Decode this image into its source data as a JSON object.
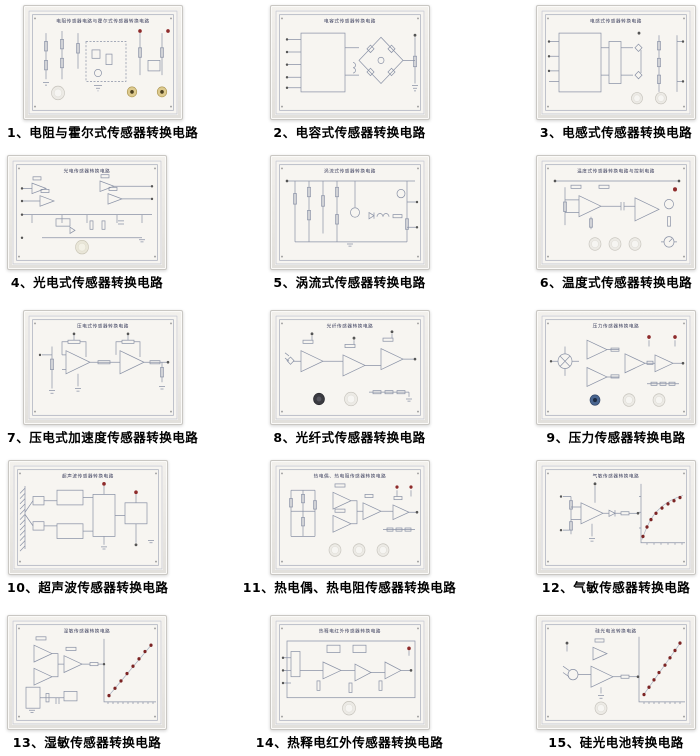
{
  "colors": {
    "led_dot": "#8e2b2b",
    "panel_face": "#f7f5f1",
    "schematic_line": "#8a92a6",
    "board_title_text": "#3f4260",
    "caption_text": "#000000"
  },
  "panels": [
    {
      "num": "1",
      "board_title": "电阻传感器电路与霍尔式传感器转换电路",
      "caption": "1、电阻与霍尔式传感器转换电路"
    },
    {
      "num": "2",
      "board_title": "电容式传感器转换电路",
      "caption": "2、电容式传感器转换电路"
    },
    {
      "num": "3",
      "board_title": "电感式传感器转换电路",
      "caption": "3、电感式传感器转换电路"
    },
    {
      "num": "4",
      "board_title": "光电传感器转换电路",
      "caption": "4、光电式传感器转换电路"
    },
    {
      "num": "5",
      "board_title": "涡流式传感器转换电路",
      "caption": "5、涡流式传感器转换电路"
    },
    {
      "num": "6",
      "board_title": "温度式传感器转换电路与控制电路",
      "caption": "6、温度式传感器转换电路"
    },
    {
      "num": "7",
      "board_title": "压电式传感器转换电路",
      "caption": "7、压电式加速度传感器转换电路"
    },
    {
      "num": "8",
      "board_title": "光纤传感器转换电路",
      "caption": "8、光纤式传感器转换电路"
    },
    {
      "num": "9",
      "board_title": "压力传感器转换电路",
      "caption": "9、压力传感器转换电路"
    },
    {
      "num": "10",
      "board_title": "超声波传感器转换电路",
      "caption": "10、超声波传感器转换电路"
    },
    {
      "num": "11",
      "board_title": "热电偶、热电阻传感器转换电路",
      "caption": "11、热电偶、热电阻传感器转换电路"
    },
    {
      "num": "12",
      "board_title": "气敏传感器转换电路",
      "caption": "12、气敏传感器转换电路"
    },
    {
      "num": "13",
      "board_title": "湿敏传感器转换电路",
      "caption": "13、湿敏传感器转换电路"
    },
    {
      "num": "14",
      "board_title": "热释电红外传感器转换电路",
      "caption": "14、热释电红外传感器转换电路"
    },
    {
      "num": "15",
      "board_title": "硅光电池转换电路",
      "caption": "15、硅光电池转换电路"
    }
  ]
}
